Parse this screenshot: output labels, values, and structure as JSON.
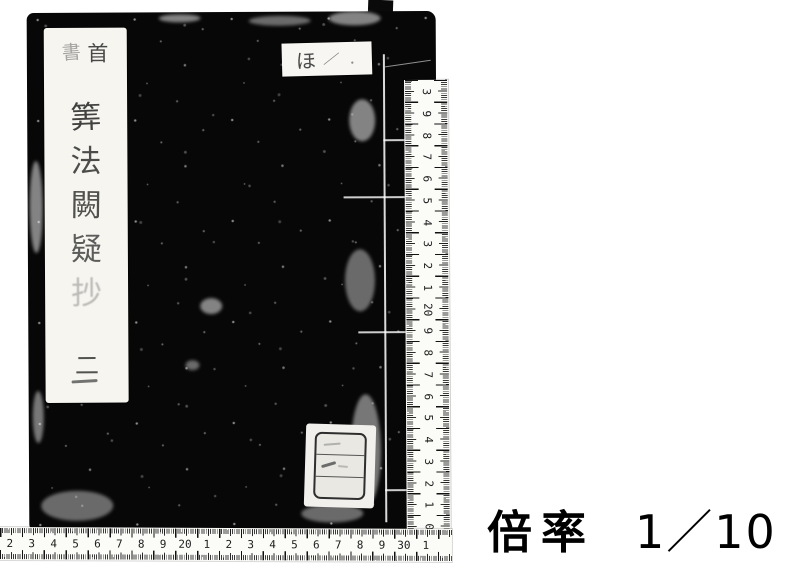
{
  "magnification": {
    "label": "倍率",
    "value": "1／10"
  },
  "book": {
    "title_slip": {
      "header_left": "書",
      "header_right": "首",
      "title_vertical": [
        "筭",
        "法",
        "闕",
        "疑",
        "抄"
      ],
      "volume": "二"
    },
    "shelf_label": {
      "char": "ほ",
      "mark": "／",
      "dot": "．"
    }
  },
  "rulers": {
    "vertical_labels_top_to_bottom": [
      "3",
      "9",
      "8",
      "7",
      "6",
      "5",
      "4",
      "3",
      "2",
      "1",
      "20",
      "9",
      "8",
      "7",
      "6",
      "5",
      "4",
      "3",
      "2",
      "1",
      "0"
    ],
    "horizontal_labels_left_to_right": [
      "2",
      "3",
      "4",
      "5",
      "6",
      "7",
      "8",
      "9",
      "20",
      "1",
      "2",
      "3",
      "4",
      "5",
      "6",
      "7",
      "8",
      "9",
      "30",
      "1"
    ]
  },
  "colors": {
    "background": "#ffffff",
    "book_cover": "#070707",
    "label_paper": "#f6f5f0",
    "ink": "#1c1c1c"
  }
}
